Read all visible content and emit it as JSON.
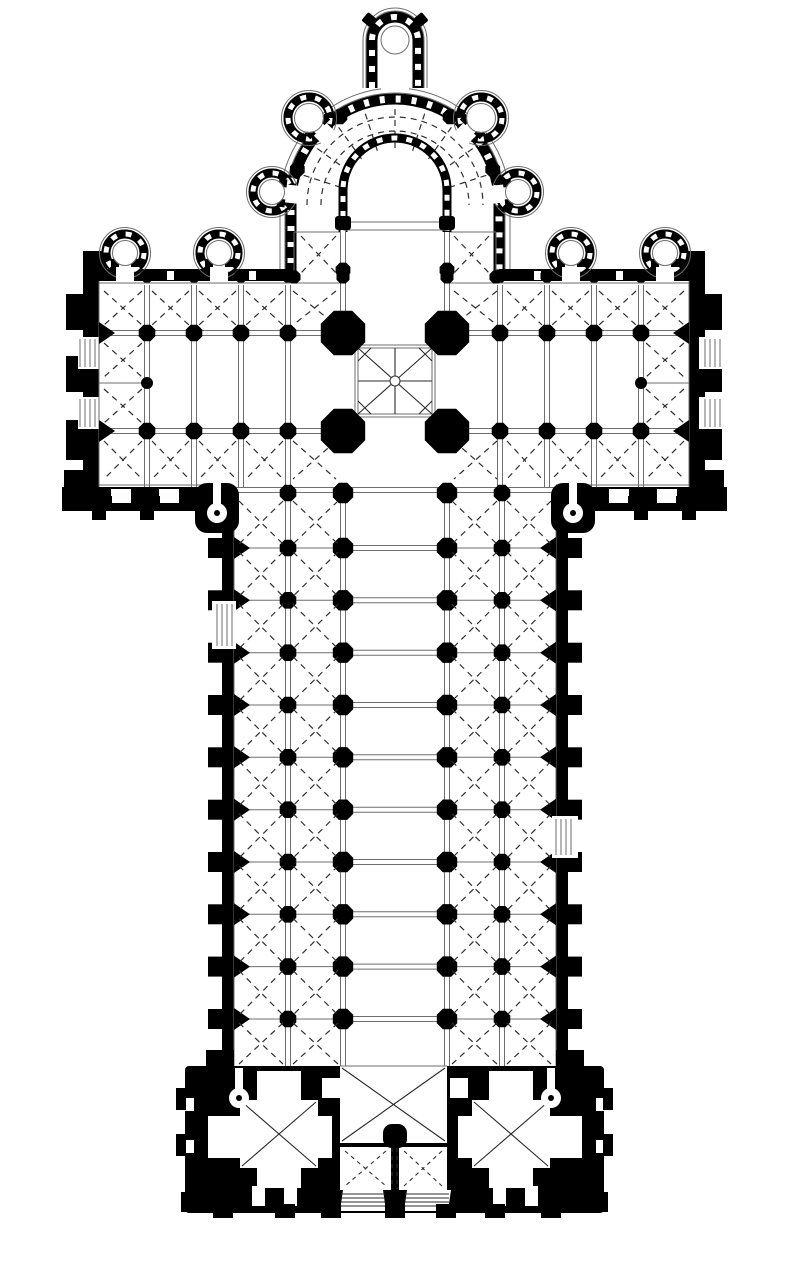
{
  "colors": {
    "ink": "#000000",
    "background": "#ffffff",
    "line": "#6e6e6e",
    "rib_dash": "#2f2f2f"
  },
  "plan": {
    "type": "cruciform-basilica-floor-plan",
    "radiating_chapels": 5,
    "transept_chapels": 4,
    "nave_bays": 11,
    "aisles_per_side": 2,
    "west_towers": 2,
    "crossing_piers": 4,
    "transept_end_portals_per_arm": 2,
    "nave_side_portals": 2
  }
}
